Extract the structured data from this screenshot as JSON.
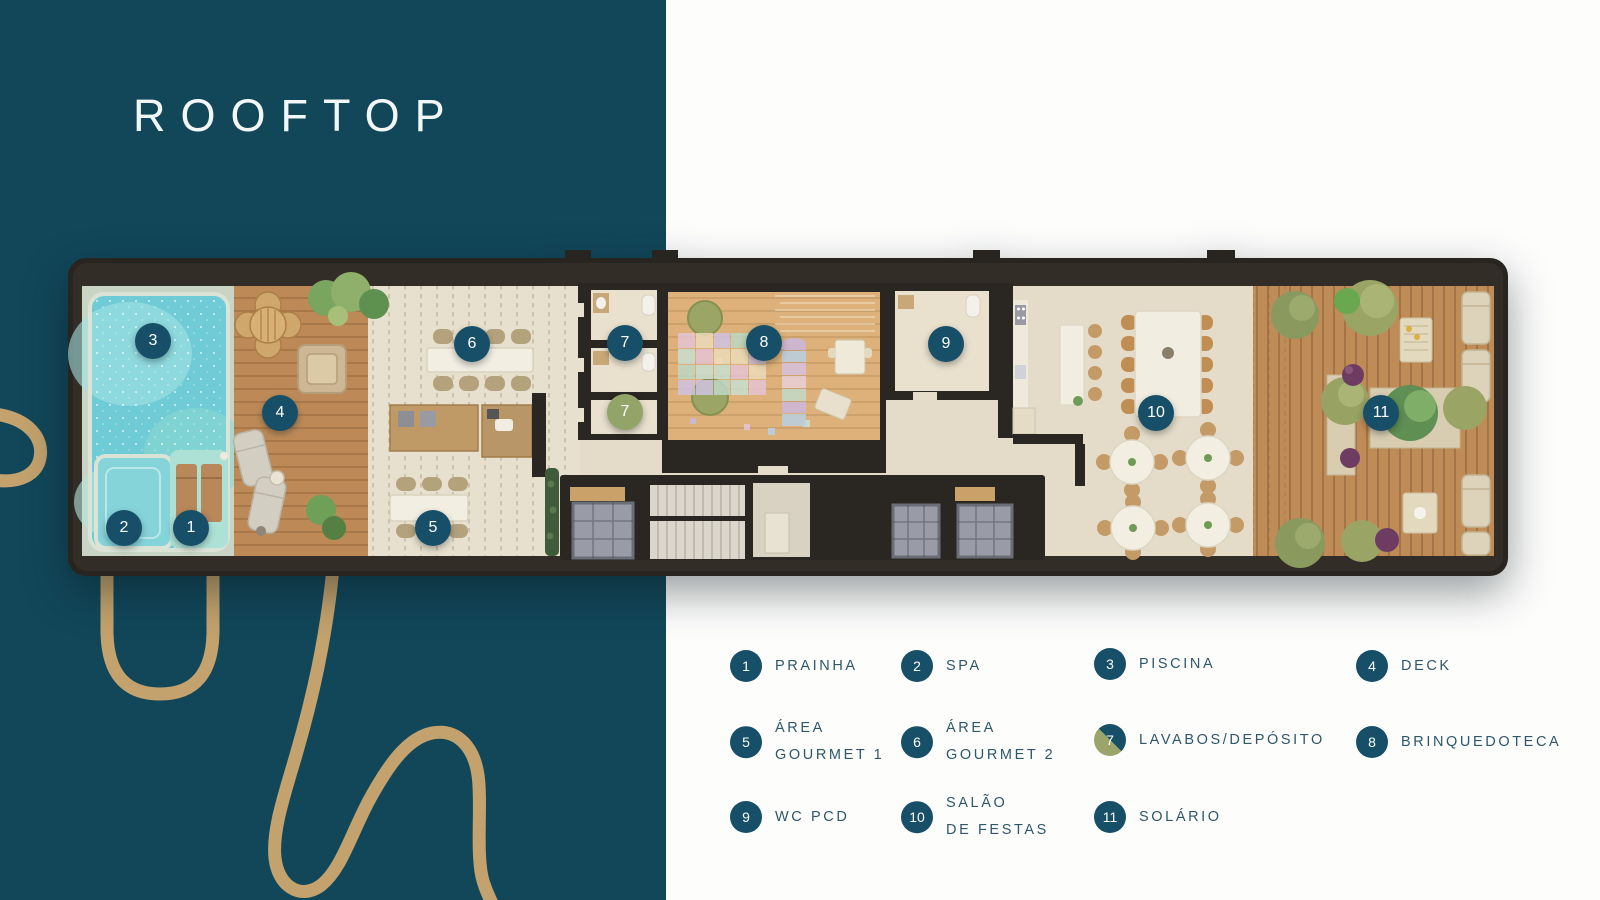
{
  "title": "ROOFTOP",
  "legend": {
    "items": [
      {
        "num": "1",
        "label": "PRAINHA",
        "variant": "teal",
        "x": 746,
        "y": 666
      },
      {
        "num": "2",
        "label": "SPA",
        "variant": "teal",
        "x": 917,
        "y": 666
      },
      {
        "num": "3",
        "label": "PISCINA",
        "variant": "teal",
        "x": 1110,
        "y": 664
      },
      {
        "num": "4",
        "label": "DECK",
        "variant": "teal",
        "x": 1372,
        "y": 666
      },
      {
        "num": "5",
        "label": "ÁREA\nGOURMET 1",
        "variant": "teal",
        "x": 746,
        "y": 742
      },
      {
        "num": "6",
        "label": "ÁREA\nGOURMET 2",
        "variant": "teal",
        "x": 917,
        "y": 742
      },
      {
        "num": "7",
        "label": "LAVABOS/DEPÓSITO",
        "variant": "split",
        "x": 1110,
        "y": 740
      },
      {
        "num": "8",
        "label": "BRINQUEDOTECA",
        "variant": "teal",
        "x": 1372,
        "y": 742
      },
      {
        "num": "9",
        "label": "WC PCD",
        "variant": "teal",
        "x": 746,
        "y": 817
      },
      {
        "num": "10",
        "label": "SALÃO\nDE FESTAS",
        "variant": "teal",
        "x": 917,
        "y": 817
      },
      {
        "num": "11",
        "label": "SOLÁRIO",
        "variant": "teal",
        "x": 1110,
        "y": 817
      }
    ]
  },
  "plan_markers": [
    {
      "num": "1",
      "x": 123,
      "y": 270,
      "variant": "teal"
    },
    {
      "num": "2",
      "x": 56,
      "y": 270,
      "variant": "teal"
    },
    {
      "num": "3",
      "x": 85,
      "y": 83,
      "variant": "teal"
    },
    {
      "num": "4",
      "x": 212,
      "y": 155,
      "variant": "teal"
    },
    {
      "num": "5",
      "x": 365,
      "y": 270,
      "variant": "teal"
    },
    {
      "num": "6",
      "x": 404,
      "y": 86,
      "variant": "teal"
    },
    {
      "num": "7",
      "x": 557,
      "y": 85,
      "variant": "teal"
    },
    {
      "num": "7",
      "x": 557,
      "y": 154,
      "variant": "olive"
    },
    {
      "num": "8",
      "x": 696,
      "y": 85,
      "variant": "teal"
    },
    {
      "num": "9",
      "x": 878,
      "y": 86,
      "variant": "teal"
    },
    {
      "num": "10",
      "x": 1088,
      "y": 155,
      "variant": "teal"
    },
    {
      "num": "11",
      "x": 1313,
      "y": 155,
      "variant": "teal"
    }
  ],
  "colors": {
    "background_teal": "#114759",
    "panel_white": "#fdfdfc",
    "accent_gold": "#c3a26d",
    "marker_teal": "#174f68",
    "marker_olive": "#93a469",
    "legend_text": "#2e576a",
    "title_text": "#f2f7f6",
    "playmat_palette": [
      "#e6c3d5",
      "#cbb8dd",
      "#bdd8c5",
      "#b9d0e3",
      "#ecdcba",
      "#d7c2e0",
      "#c8dfd2",
      "#e9cfd9",
      "#cfc3e2",
      "#c3dbc9"
    ]
  }
}
